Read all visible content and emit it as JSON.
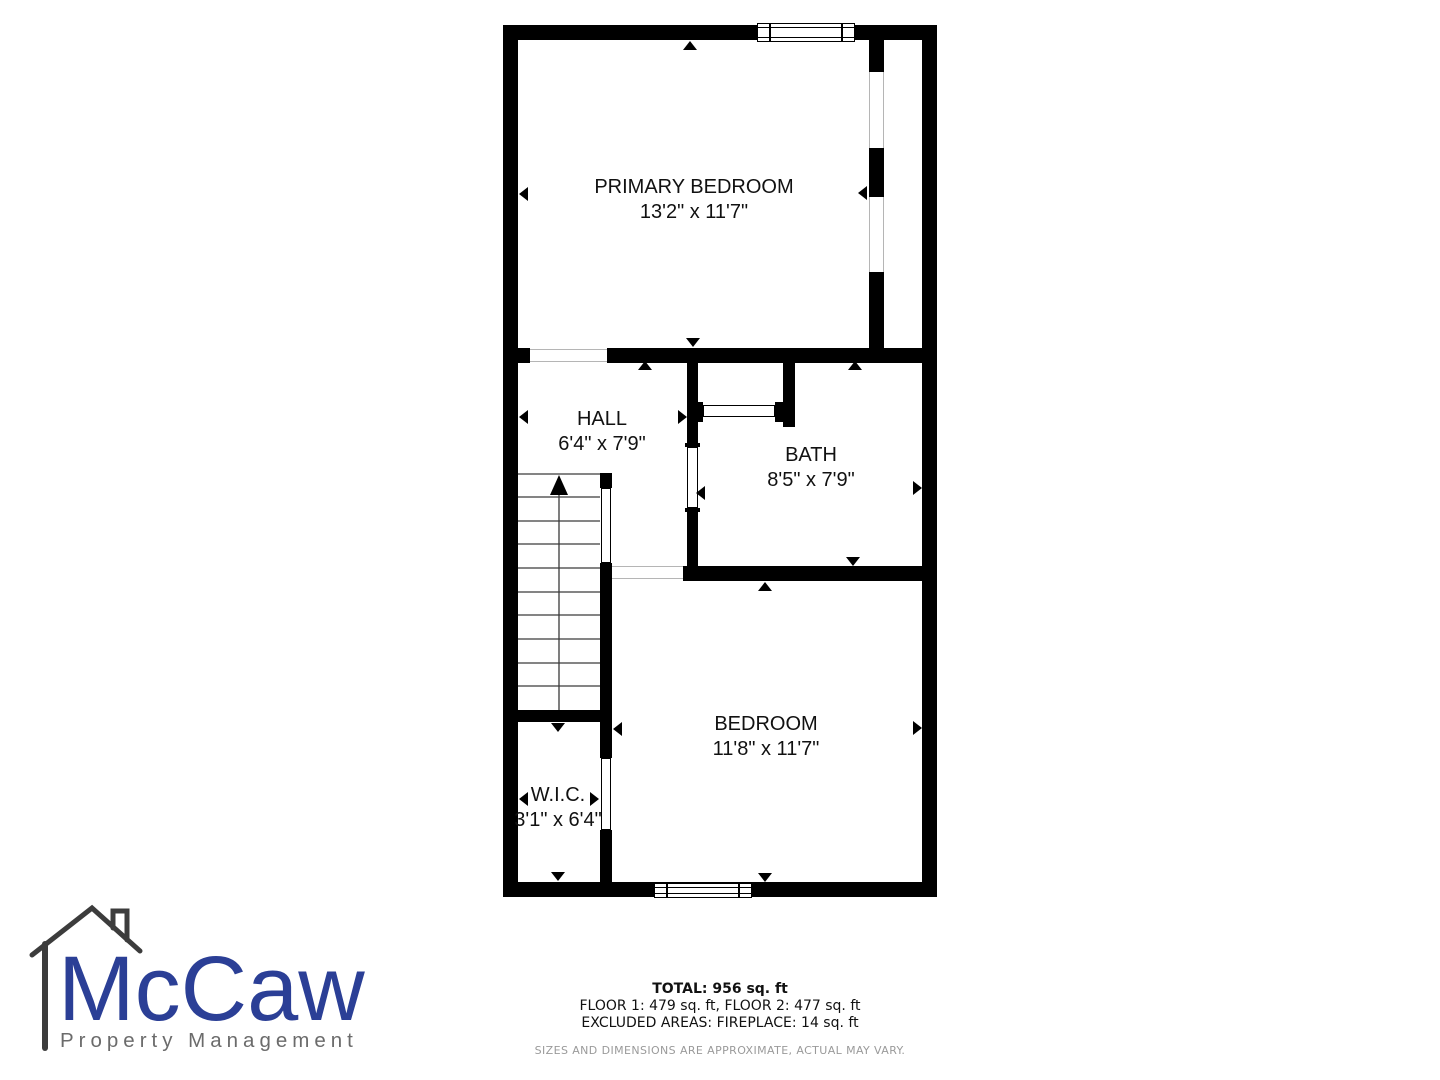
{
  "floorplan": {
    "rooms": {
      "primary_bedroom": {
        "name": "PRIMARY BEDROOM",
        "dims": "13'2\" x 11'7\""
      },
      "hall": {
        "name": "HALL",
        "dims": "6'4\" x 7'9\""
      },
      "bath": {
        "name": "BATH",
        "dims": "8'5\" x 7'9\""
      },
      "bedroom": {
        "name": "BEDROOM",
        "dims": "11'8\" x 11'7\""
      },
      "wic": {
        "name": "W.I.C.",
        "dims": "3'1\" x 6'4\""
      }
    }
  },
  "summary": {
    "total": "TOTAL: 956 sq. ft",
    "floors": "FLOOR 1: 479 sq. ft, FLOOR 2: 477 sq. ft",
    "excluded": "EXCLUDED AREAS: FIREPLACE: 14 sq. ft",
    "disclaimer": "SIZES AND DIMENSIONS ARE APPROXIMATE, ACTUAL MAY VARY."
  },
  "logo": {
    "brand": "McCaw",
    "tagline": "Property Management",
    "brand_color": "#2b3f96",
    "tagline_color": "#6b6b6b",
    "house_color": "#3c3c3c"
  },
  "colors": {
    "wall": "#000000",
    "background": "#ffffff"
  }
}
